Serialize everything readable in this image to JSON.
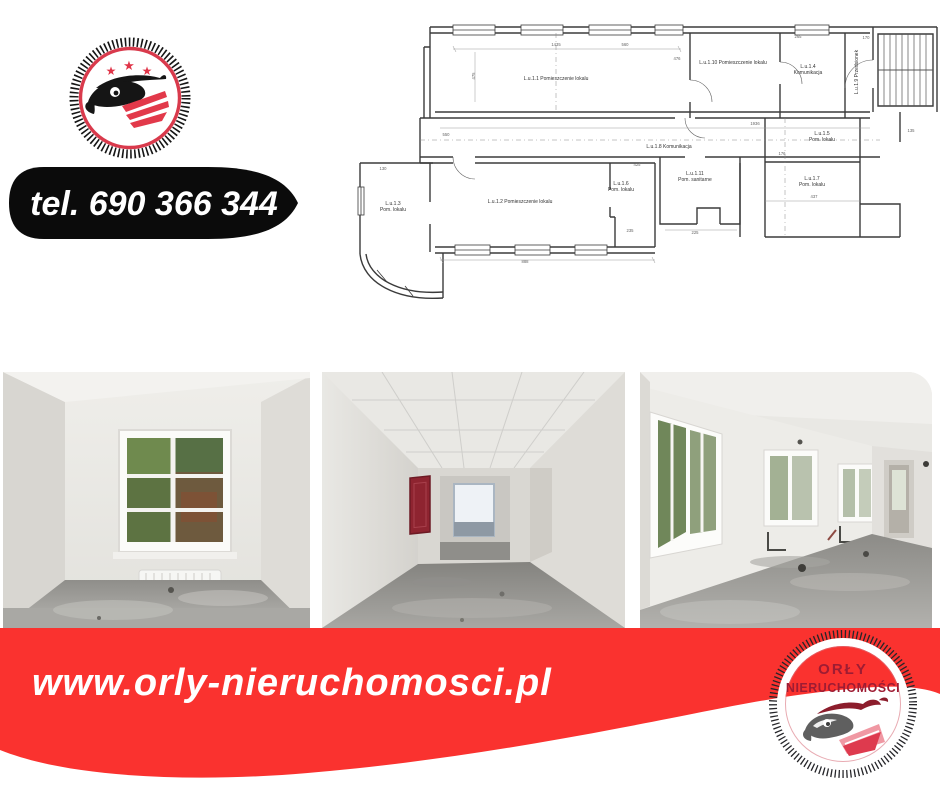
{
  "header": {
    "phone_label": "tel. 690 366 344"
  },
  "footer": {
    "website": "www.orly-nieruchomosci.pl",
    "stamp": {
      "line1": "ORŁY",
      "line2": "NIERUCHOMOŚCI"
    }
  },
  "colors": {
    "accent_red": "#FA322F",
    "logo_red": "#E2394A",
    "stamp_text": "#9E1C33",
    "hydrant_red": "#8E2430",
    "plan_line": "#3B3B3B"
  },
  "floorplan": {
    "room_labels": [
      {
        "text": "L.u.1.1 Pomieszczenie lokalu",
        "x": 231,
        "y": 78
      },
      {
        "text": "L.u.1.10 Pomieszczenie lokalu",
        "x": 408,
        "y": 62
      },
      {
        "text": "L.u.1.4",
        "x": 483,
        "y": 66
      },
      {
        "text": "Komunikacja",
        "x": 483,
        "y": 72
      },
      {
        "text": "L.u.1.9 Przedsionek",
        "x": 533,
        "y": 70,
        "rotate": -90
      },
      {
        "text": "L.u.1.8 Komunikacja",
        "x": 344,
        "y": 146
      },
      {
        "text": "L.u.1.3",
        "x": 68,
        "y": 203
      },
      {
        "text": "Pom. lokalu",
        "x": 68,
        "y": 209
      },
      {
        "text": "L.u.1.2 Pomieszczenie lokalu",
        "x": 195,
        "y": 201
      },
      {
        "text": "L.u.1.6",
        "x": 296,
        "y": 183
      },
      {
        "text": "Pom. lokalu",
        "x": 296,
        "y": 189
      },
      {
        "text": "L.u.1.11",
        "x": 370,
        "y": 173
      },
      {
        "text": "Pom. sanitarne",
        "x": 370,
        "y": 179
      },
      {
        "text": "L.u.1.5",
        "x": 497,
        "y": 133
      },
      {
        "text": "Pom. lokalu",
        "x": 497,
        "y": 139
      },
      {
        "text": "L.u.1.7",
        "x": 487,
        "y": 178
      },
      {
        "text": "Pom. lokalu",
        "x": 487,
        "y": 184
      }
    ],
    "dimension_labels": [
      {
        "text": "1435",
        "x": 231,
        "y": 44
      },
      {
        "text": "475",
        "x": 150,
        "y": 74,
        "rotate": -90
      },
      {
        "text": "1936",
        "x": 430,
        "y": 123
      },
      {
        "text": "550",
        "x": 121,
        "y": 134
      },
      {
        "text": "888",
        "x": 200,
        "y": 261
      },
      {
        "text": "235",
        "x": 305,
        "y": 230
      },
      {
        "text": "425",
        "x": 312,
        "y": 164
      },
      {
        "text": "437",
        "x": 489,
        "y": 196
      },
      {
        "text": "476",
        "x": 352,
        "y": 58
      },
      {
        "text": "170",
        "x": 541,
        "y": 37
      },
      {
        "text": "176",
        "x": 457,
        "y": 153
      },
      {
        "text": "135",
        "x": 586,
        "y": 130
      },
      {
        "text": "225",
        "x": 370,
        "y": 232
      },
      {
        "text": "265",
        "x": 473,
        "y": 36
      },
      {
        "text": "560",
        "x": 300,
        "y": 44
      },
      {
        "text": "130",
        "x": 58,
        "y": 168
      }
    ]
  }
}
